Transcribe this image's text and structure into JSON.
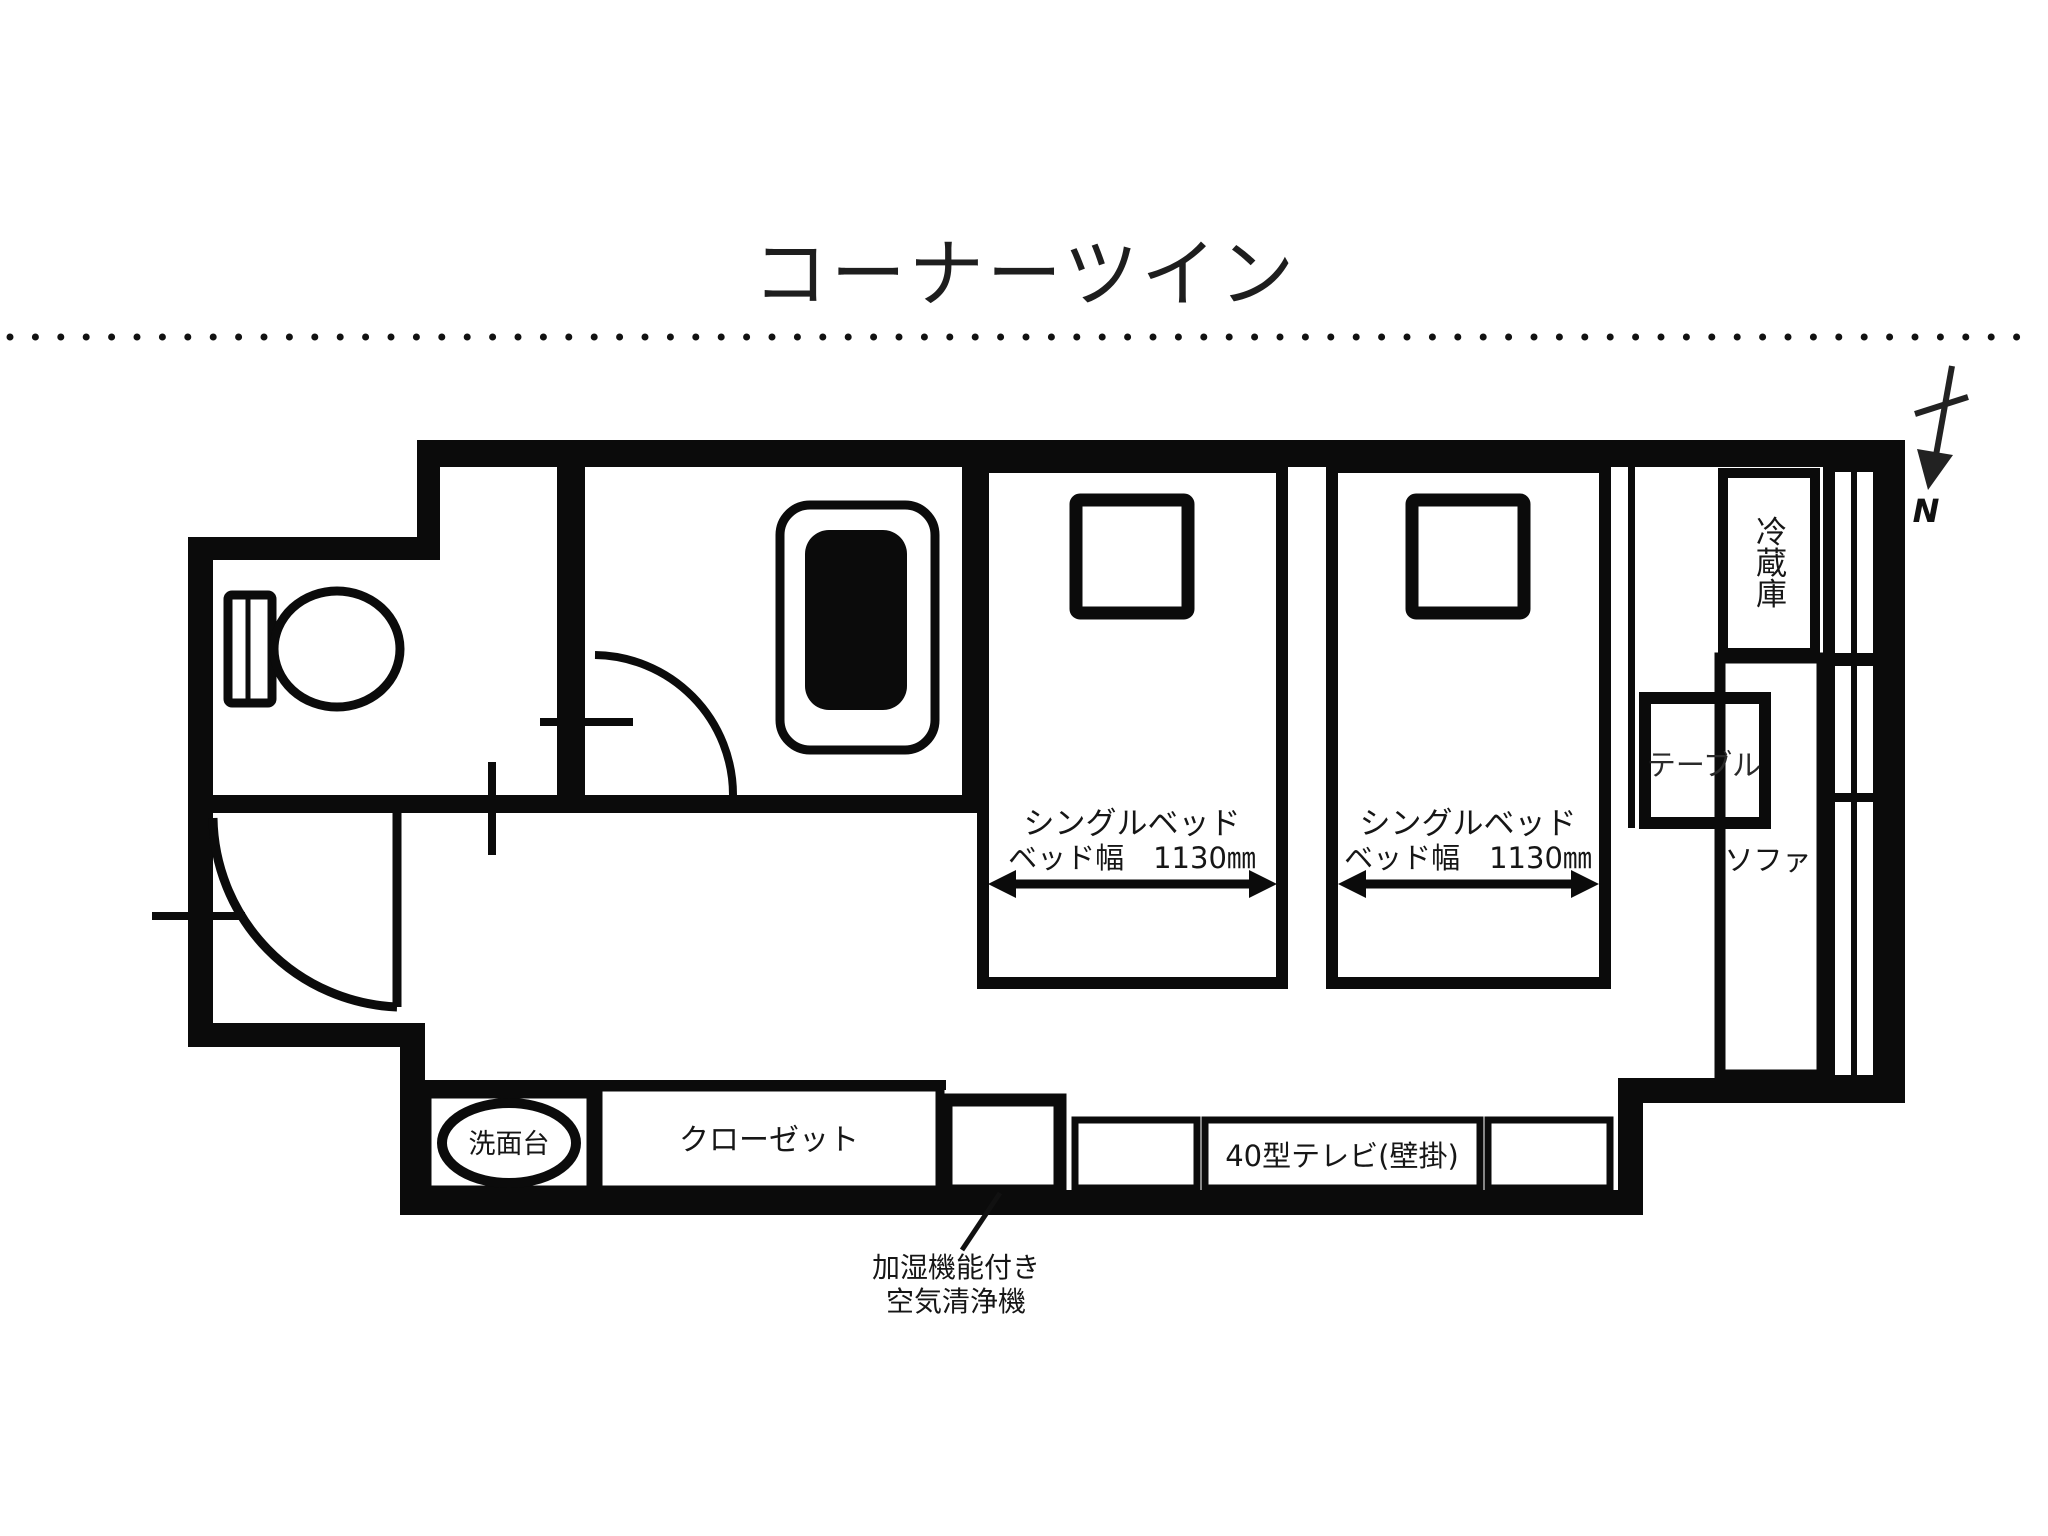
{
  "title": "コーナーツイン",
  "compass": {
    "north_label": "N"
  },
  "labels": {
    "refrigerator": "冷蔵庫",
    "table": "テーブル",
    "sofa": "ソファ",
    "washstand": "洗面台",
    "closet": "クローゼット",
    "tv": "40型テレビ(壁掛)",
    "air_purifier_line1": "加湿機能付き",
    "air_purifier_line2": "空気清浄機"
  },
  "beds": {
    "bed1": {
      "name": "シングルベッド",
      "width_label": "ベッド幅　1130㎜"
    },
    "bed2": {
      "name": "シングルベッド",
      "width_label": "ベッド幅　1130㎜"
    }
  },
  "colors": {
    "ink": "#0b0b0b",
    "background": "#ffffff"
  }
}
